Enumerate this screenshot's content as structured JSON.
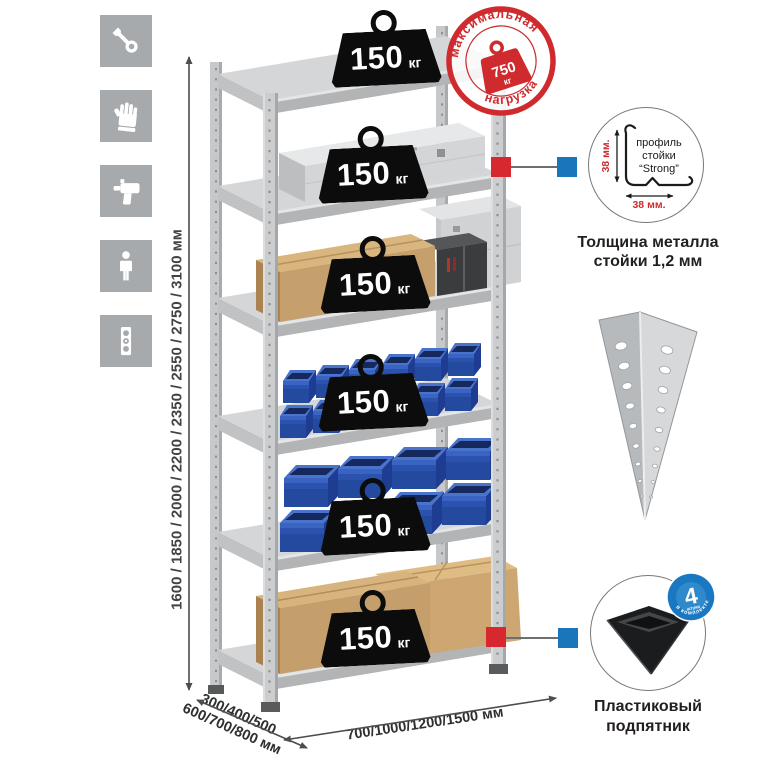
{
  "canvas": {
    "width": 765,
    "height": 765,
    "background": "#ffffff"
  },
  "sidebar_icons": [
    {
      "name": "wrench-icon"
    },
    {
      "name": "gloves-icon"
    },
    {
      "name": "drill-icon"
    },
    {
      "name": "person-icon"
    },
    {
      "name": "level-icon"
    }
  ],
  "dimensions": {
    "height_label": "1600 / 1850 / 2000 / 2200 / 2350 / 2550 / 2750 / 3100 мм",
    "depth_label_line1": "300/400/500",
    "depth_label_line2": "600/700/800 мм",
    "width_label": "700/1000/1200/1500 мм"
  },
  "shelves": [
    {
      "load_value": "150",
      "load_unit": "кг"
    },
    {
      "load_value": "150",
      "load_unit": "кг"
    },
    {
      "load_value": "150",
      "load_unit": "кг"
    },
    {
      "load_value": "150",
      "load_unit": "кг"
    },
    {
      "load_value": "150",
      "load_unit": "кг"
    },
    {
      "load_value": "150",
      "load_unit": "кг"
    }
  ],
  "max_load_stamp": {
    "arc_top": "максимальная",
    "arc_bottom": "нагрузка",
    "value": "750",
    "unit": "кг"
  },
  "post_profile": {
    "label_line1": "профиль",
    "label_line2": "стойки",
    "label_line3": "“Strong”",
    "dim_vertical": "38 мм.",
    "dim_horizontal": "38 мм.",
    "caption_line1": "Толщина металла",
    "caption_line2": "стойки 1,2 мм"
  },
  "foot": {
    "badge_value": "4",
    "badge_sub": "штуки",
    "badge_arc": "в комплекте",
    "caption_line1": "Пластиковый",
    "caption_line2": "подпятник"
  },
  "colors": {
    "stamp_red": "#cf2b2e",
    "marker_red": "#d7282f",
    "marker_blue": "#1b75bb",
    "bin_blue": "#2a52ae",
    "icon_tile_gray": "#a7aaac",
    "badge_black": "#0c0c0c",
    "metal_gray": "#c9cbcd",
    "dimension_text": "#414244"
  }
}
